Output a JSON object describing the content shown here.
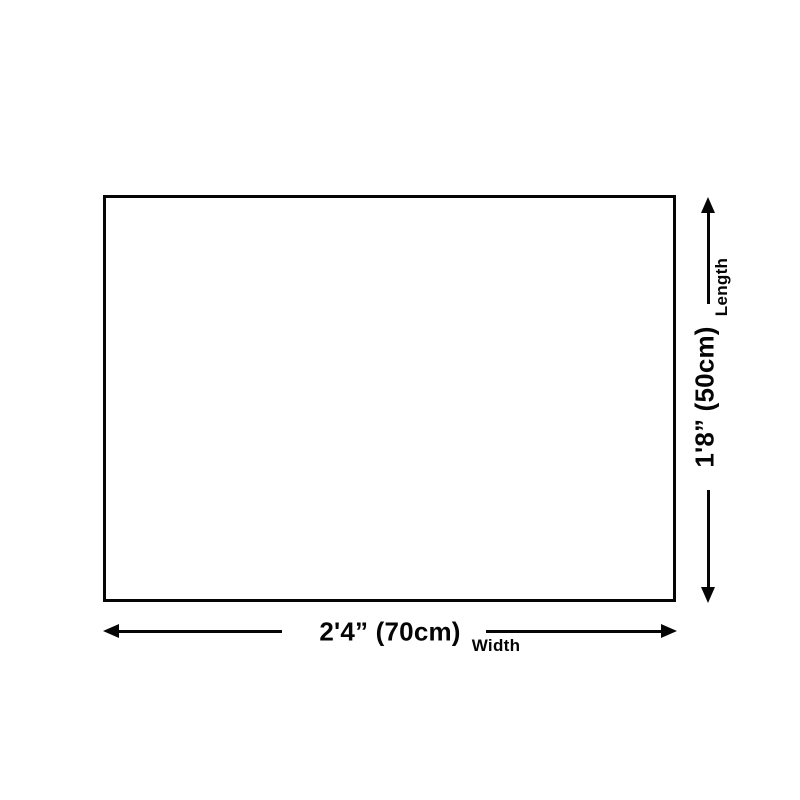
{
  "diagram": {
    "type": "product-dimension-diagram",
    "background_color": "#ffffff",
    "line_color": "#050505",
    "panel_fill": "#ffffff",
    "width_dimension": {
      "value": "2'4” (70cm)",
      "caption": "Width"
    },
    "length_dimension": {
      "value": "1'8” (50cm)",
      "caption": "Length"
    },
    "icons": {
      "arrow-left-icon": "css-triangle-pointing-left",
      "arrow-right-icon": "css-triangle-pointing-right",
      "arrow-up-icon": "css-triangle-pointing-up",
      "arrow-down-icon": "css-triangle-pointing-down"
    }
  }
}
